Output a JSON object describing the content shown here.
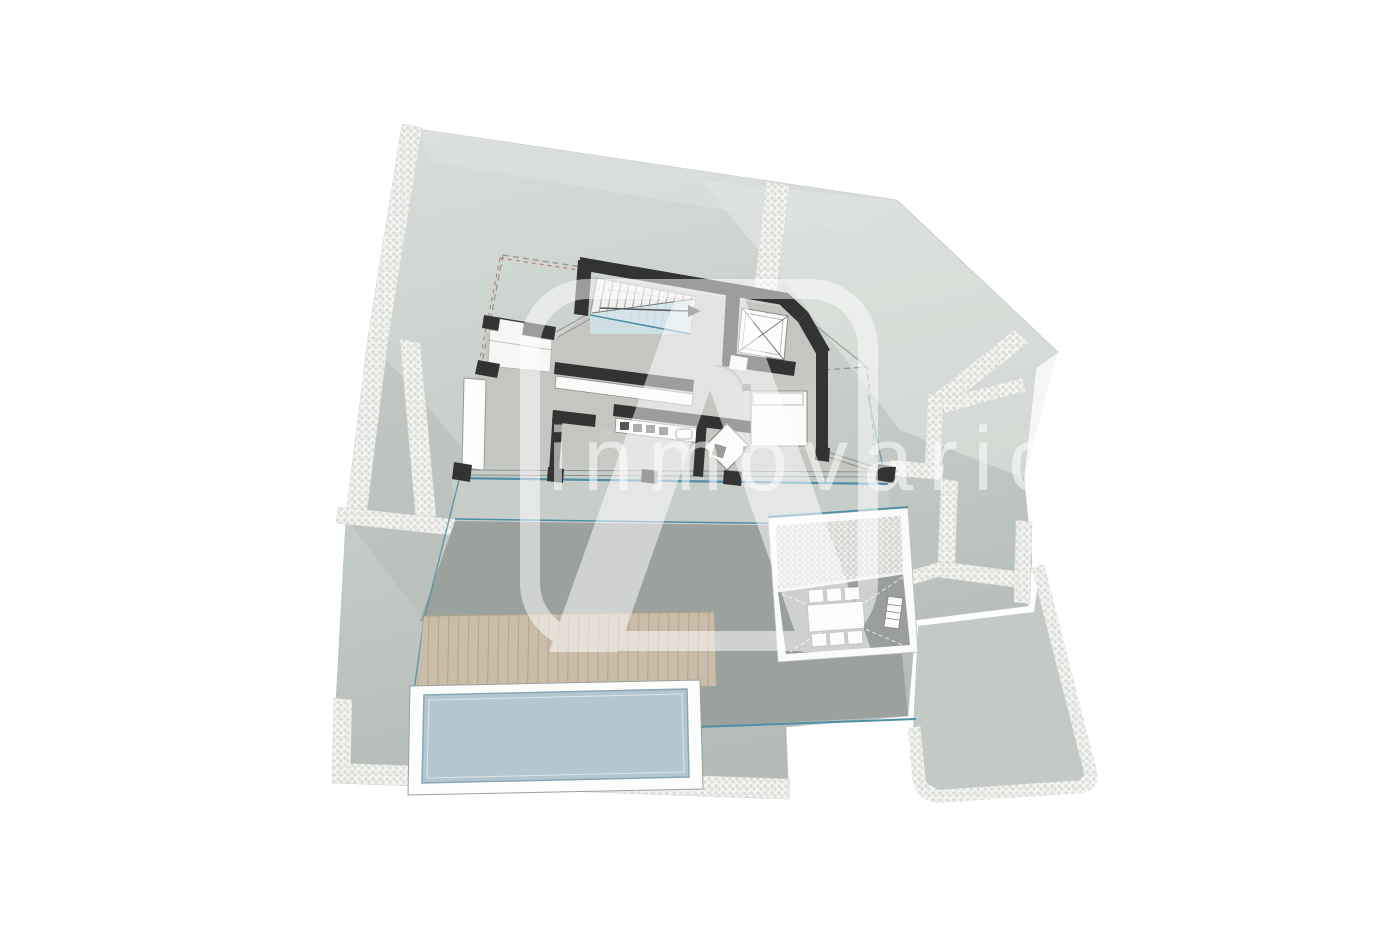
{
  "image": {
    "kind": "architectural floor plan",
    "description": "villa site plan with pool terrace"
  },
  "watermark": {
    "brand_text": "inmovario",
    "logo": "rounded-square-a-logo"
  },
  "colors": {
    "background": "#ffffff",
    "terrain_light": "#d8ddd9",
    "terrain_mid": "#c9d0cc",
    "terrain_dark": "#b6bdb9",
    "terrace_band": "#c7cdc9",
    "terrace_dark": "#9ba19d",
    "deck_wood": "#c9bdaa",
    "deck_slat_line": "#b2a58c",
    "pool_water": "#b4c6cf",
    "pool_edge": "#8fa9b5",
    "wall": "#333333",
    "floor": "#c5c6c2",
    "floor_light": "#cfd0cc",
    "furniture_fill": "#fbfbfa",
    "furniture_line": "#8a8a86",
    "gravel": "#f3f3f1",
    "gravel_dot": "#c9c9c5",
    "accent_teal": "#4e8ea6",
    "stairs_blue": "#cfe3ea",
    "boundary_dash": "#9a9a96",
    "boundary_dash_red": "#b55a4e",
    "patio_floor": "#9a9f9b",
    "watermark_white": "#ffffff"
  },
  "elements": {
    "staircase": "staircase-with-direction-arrow",
    "elevator": "elevator-shaft-x-icon",
    "bed": "double-bed",
    "desk_chair": "desk-with-rotated-chair",
    "kitchen": "kitchen-counter-with-appliances",
    "pool": "swimming-pool",
    "deck": "wood-deck-slats",
    "dining_set": "outdoor-dining-table-six-chairs",
    "lounger": "sun-lounger",
    "gravel_paths": "gravel-footpaths",
    "plot_boundary": "dashed-plot-boundary"
  }
}
